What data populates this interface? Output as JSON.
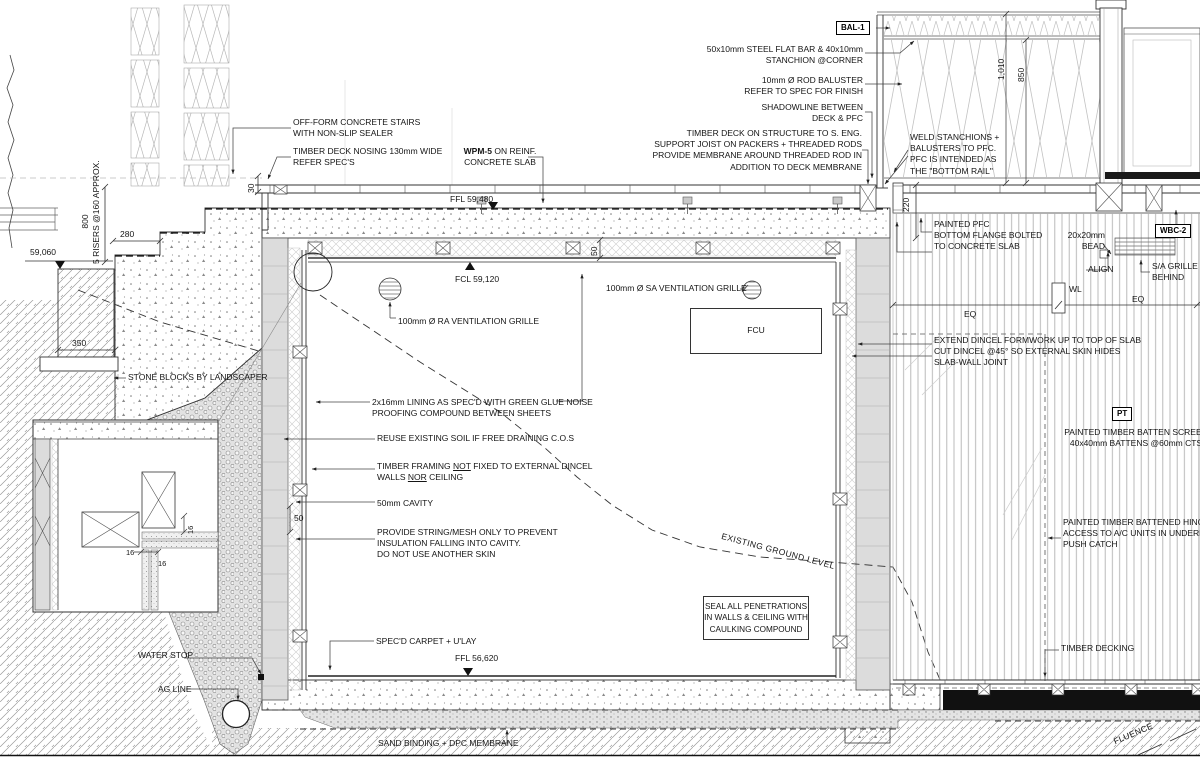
{
  "a": {
    "bal1": "BAL-1",
    "steel_bar": "50x10mm STEEL FLAT BAR & 40x10mm\nSTANCHION @CORNER",
    "rod_baluster": "10mm Ø ROD BALUSTER\nREFER TO SPEC FOR FINISH",
    "shadowline": "SHADOWLINE BETWEEN\nDECK & PFC",
    "deck_structure": "TIMBER DECK ON STRUCTURE TO S. ENG.\nSUPPORT JOIST ON PACKERS + THREADED RODS\nPROVIDE MEMBRANE AROUND THREADED ROD IN\nADDITION TO DECK MEMBRANE",
    "weld_stanchions": "WELD STANCHIONS +\nBALUSTERS TO PFC.\nPFC IS INTENDED AS\nTHE \"BOTTOM RAIL\"",
    "off_form_stairs": "OFF-FORM CONCRETE STAIRS\nWITH NON-SLIP SEALER",
    "deck_nosing": "TIMBER DECK NOSING 130mm WIDE\nREFER SPEC'S",
    "wpm5_bold": "WPM-5",
    "wpm5_rest": " ON REINF.",
    "wpm5_line2": "CONCRETE SLAB",
    "ffl_upper": "FFL 59,480",
    "fcl": "FCL 59,120",
    "ffl_lower": "FFL 56,620",
    "datum_59060": "59,060",
    "risers_800": "800",
    "risers_note": "5 RISERS @160 APPROX.",
    "d280": "280",
    "d350": "350",
    "d30": "30",
    "d220": "220",
    "d1010": "1,010",
    "d850": "850",
    "d50_ceiling": "50",
    "d50_wall": "50",
    "d16a": "16",
    "d16b": "16",
    "d16c": "16",
    "stone_blocks": "STONE BLOCKS BY LANDSCAPER",
    "ra_grille": "100mm Ø RA VENTILATION GRILLE",
    "sa_grille": "100mm Ø SA VENTILATION GRILLE",
    "fcu": "FCU",
    "lining": "2x16mm LINING AS SPEC'D WITH GREEN GLUE NOISE\nPROOFING COMPOUND BETWEEN SHEETS",
    "reuse_soil": "REUSE EXISTING SOIL IF FREE DRAINING C.O.S",
    "framing_pre": "TIMBER FRAMING ",
    "framing_not": "NOT",
    "framing_mid": " FIXED TO EXTERNAL DINCEL",
    "framing_l2pre": "WALLS ",
    "framing_nor": "NOR",
    "framing_l2post": " CEILING",
    "cavity": "50mm CAVITY",
    "string_mesh": "PROVIDE STRING/MESH ONLY TO PREVENT\nINSULATION FALLING INTO CAVITY.\nDO NOT USE ANOTHER SKIN",
    "seal_penetrations": "SEAL ALL PENETRATIONS\nIN WALLS & CEILING WITH\nCAULKING COMPOUND",
    "existing_ground": "EXISTING GROUND LEVEL",
    "carpet": "SPEC'D CARPET + U'LAY",
    "water_stop": "WATER STOP",
    "ag_line": "AG LINE",
    "sand_binding": "SAND BINDING + DPC MEMBRANE",
    "painted_pfc": "PAINTED PFC\nBOTTOM FLANGE BOLTED\nTO CONCRETE SLAB",
    "bead": "20x20mm\nBEAD",
    "wbc2": "WBC-2",
    "align": "ALIGN",
    "sa_grille_behind": "S/A GRILLE\nBEHIND",
    "wl": "WL",
    "eq_left": "EQ",
    "eq_right": "EQ",
    "extend_dincel": "EXTEND DINCEL FORMWORK UP TO TOP OF SLAB\nCUT DINCEL @45° SO EXTERNAL SKIN HIDES\nSLAB-WALL JOINT",
    "pt": "PT",
    "batten_screen": "PAINTED TIMBER BATTEN SCREEN\n40x40mm BATTENS @60mm CTS",
    "hinged_door": "PAINTED TIMBER BATTENED HINGED DO\nACCESS TO A/C UNITS IN UNDERFLOOR S\nPUSH CATCH",
    "timber_decking": "TIMBER DECKING",
    "influence_partial": "FLUENCE"
  }
}
